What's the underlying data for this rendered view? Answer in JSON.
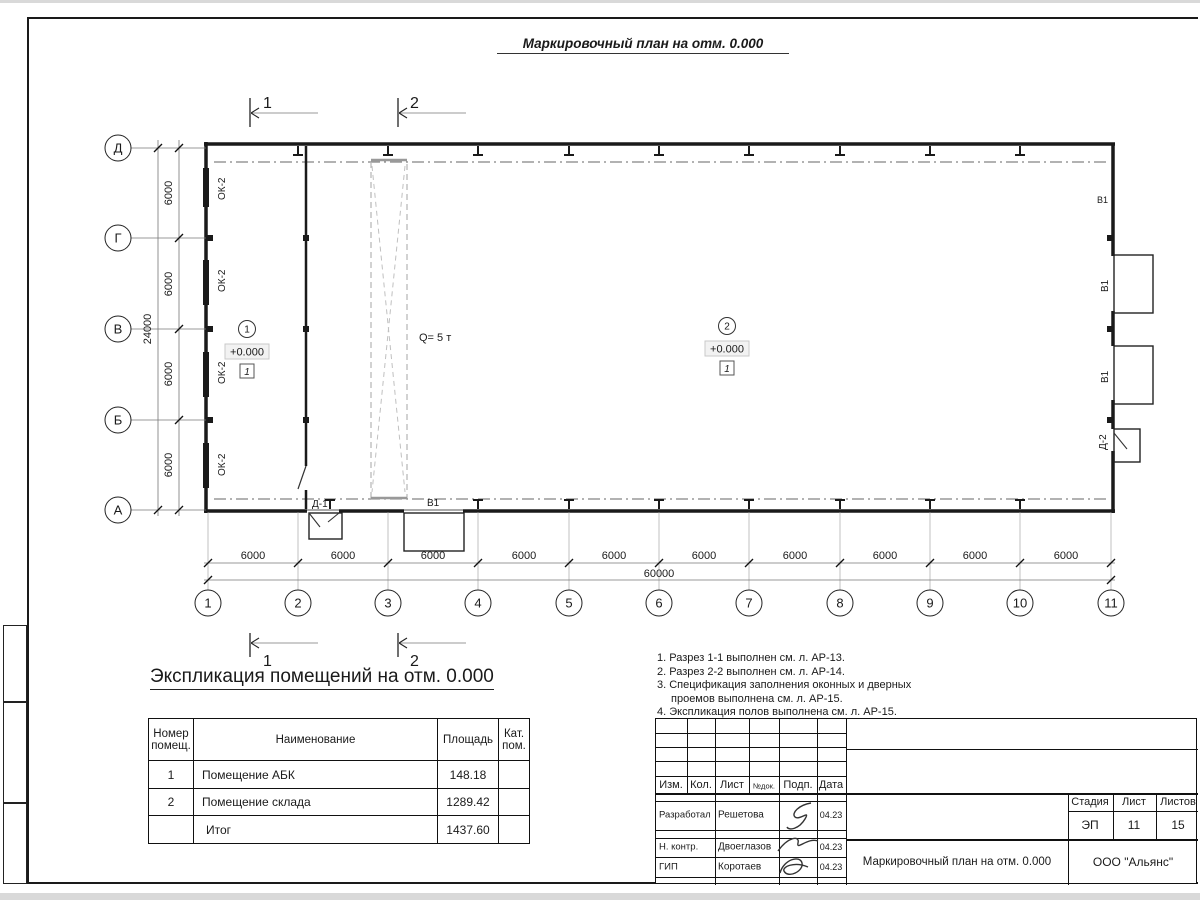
{
  "sheet": {
    "title": "Маркировочный план на отм. 0.000",
    "expl_title": "Экспликация помещений на отм. 0.000"
  },
  "plan": {
    "axes_letters": [
      "Д",
      "Г",
      "В",
      "Б",
      "А"
    ],
    "axes_numbers": [
      "1",
      "2",
      "3",
      "4",
      "5",
      "6",
      "7",
      "8",
      "9",
      "10",
      "11"
    ],
    "bay_dim": "6000",
    "total_width": "60000",
    "total_height": "24000",
    "window_label": "ОК-2",
    "gate_label": "В1",
    "door1_label": "Д-1",
    "door2_label": "Д-2",
    "crane_label": "Q= 5 т",
    "elevation": "+0.000",
    "floor_mark": "1",
    "room1_num": "1",
    "room2_num": "2",
    "section1": "1",
    "section2": "2"
  },
  "expl_table": {
    "headers": [
      "Номер помещ.",
      "Наименование",
      "Площадь",
      "Кат. пом."
    ],
    "rows": [
      {
        "num": "1",
        "name": "Помещение АБК",
        "area": "148.18",
        "cat": ""
      },
      {
        "num": "2",
        "name": "Помещение склада",
        "area": "1289.42",
        "cat": ""
      },
      {
        "num": "",
        "name": "Итог",
        "area": "1437.60",
        "cat": ""
      }
    ]
  },
  "notes": {
    "lines": [
      "1. Разрез 1-1 выполнен см. л. АР-13.",
      "2. Разрез 2-2 выполнен см. л. АР-14.",
      "3. Спецификация заполнения оконных и дверных",
      "проемов выполнена см. л. АР-15.",
      "4. Экспликация полов выполнена см. л. АР-15."
    ]
  },
  "stamp": {
    "header_cols": [
      "Изм.",
      "Кол.",
      "Лист",
      "№док.",
      "Подп.",
      "Дата"
    ],
    "rows": [
      {
        "role": "Разработал",
        "name": "Решетова",
        "date": "04.23"
      },
      {
        "role": "Н. контр.",
        "name": "Двоеглазов",
        "date": "04.23"
      },
      {
        "role": "ГИП",
        "name": "Коротаев",
        "date": "04.23"
      }
    ],
    "stage_label": "Стадия",
    "sheet_label": "Лист",
    "sheets_label": "Листов",
    "stage": "ЭП",
    "sheet": "11",
    "sheets": "15",
    "doc_title": "Маркировочный план на отм. 0.000",
    "company": "ООО \"Альянс\""
  }
}
